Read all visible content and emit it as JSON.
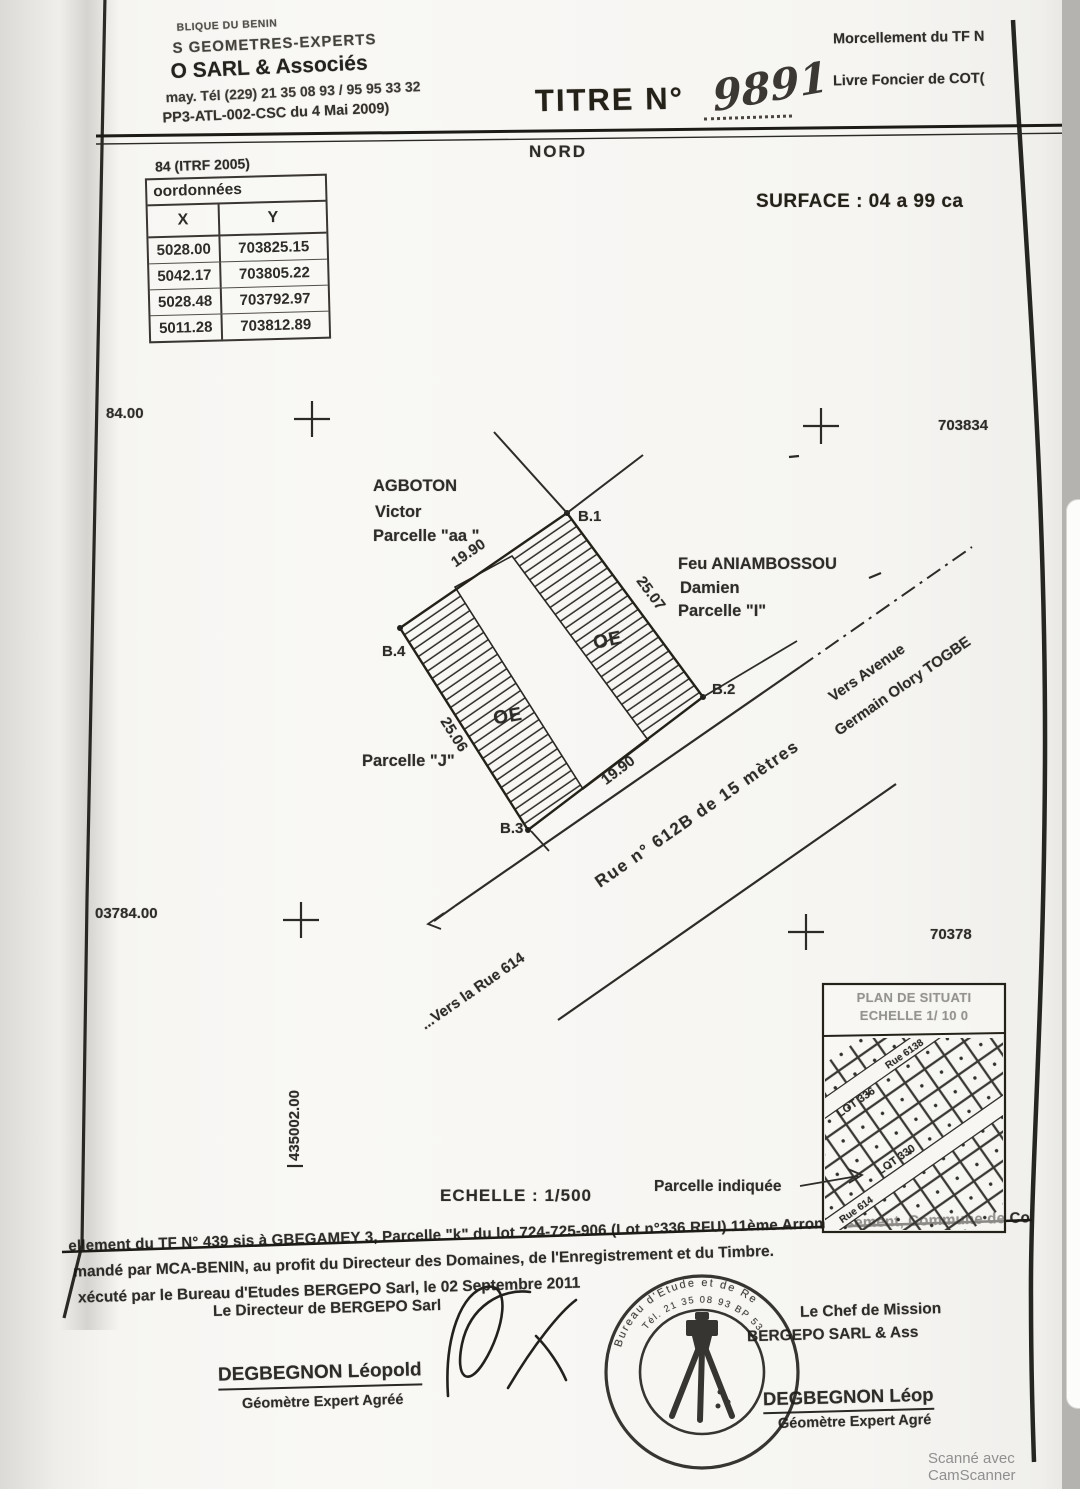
{
  "document": {
    "letterhead": {
      "line1": "BLIQUE DU BENIN",
      "line2": "S GEOMETRES-EXPERTS",
      "line3": "O SARL & Associés",
      "line4": "may. Tél  (229) 21 35 08 93 / 95 95 33 32",
      "line5": "PP3-ATL-002-CSC du 4 Mai 2009)"
    },
    "title_label": "TITRE N°",
    "title_number": "9891",
    "ref_right1": "Morcellement du TF N",
    "ref_right2": "Livre Foncier de COT(",
    "north_label": "NORD",
    "datum": "84 (ITRF 2005)",
    "surface": "SURFACE : 04 a 99 ca",
    "coords_table": {
      "title": "oordonnées",
      "col_x": "X",
      "col_y": "Y",
      "rows": [
        [
          "5028.00",
          "703825.15"
        ],
        [
          "5042.17",
          "703805.22"
        ],
        [
          "5028.48",
          "703792.97"
        ],
        [
          "5011.28",
          "703812.89"
        ]
      ]
    },
    "grid": {
      "left_top": "84.00",
      "right_top": "703834",
      "left_bottom": "03784.00",
      "right_bottom": "70378",
      "vertical": "435002.00"
    },
    "parcel": {
      "b1": "B.1",
      "b2": "B.2",
      "b3": "B.3",
      "b4": "B.4",
      "len_nw": "19.90",
      "len_ne": "25.07",
      "len_sw": "25.06",
      "len_se": "19.90",
      "oe": "OE",
      "neighbor_nw1": "AGBOTON",
      "neighbor_nw2": "Victor",
      "neighbor_nw3": "Parcelle \"aa \"",
      "neighbor_ne1": "Feu ANIAMBOSSOU",
      "neighbor_ne2": "Damien",
      "neighbor_ne3": "Parcelle \"I\"",
      "neighbor_sw": "Parcelle \"J\""
    },
    "roads": {
      "rue_612b": "Rue n° 612B de 15 mètres",
      "vers_rue_614": "...Vers la Rue 614",
      "vers_avenue1": "Vers Avenue",
      "vers_avenue2": "Germain Olory TOGBE"
    },
    "scale": "ECHELLE : 1/500",
    "situation": {
      "title1": "PLAN DE SITUATI",
      "title2": "ECHELLE 1/ 10 0",
      "lot_a": "LOT 336",
      "rue_a": "Rue 6138",
      "lot_b": "LOT 330",
      "rue_b": "Rue 614",
      "pointer": "Parcelle indiquée"
    },
    "footer": {
      "p1": "ellement du TF N° 439 sis à GBEGAMEY 3, Parcelle \"k\" du lot 724-725-906 (Lot n°336 RFU) 11ème Arrondissement, Commune de Co",
      "p2": "mandé par MCA-BENIN, au profit du Directeur des Domaines, de l'Enregistrement et du Timbre.",
      "p3": "xécuté par le Bureau d'Etudes BERGEPO Sarl, le 02 Septembre 2011",
      "left_role": "Le Directeur de BERGEPO Sarl",
      "left_name": "DEGBEGNON Léopold",
      "left_title": "Géomètre Expert Agréé",
      "right_role": "Le Chef de Mission",
      "right_org": "BERGEPO SARL & Ass",
      "right_name": "DEGBEGNON Léop",
      "right_title": "Géomètre Expert Agré"
    },
    "stamp": {
      "arc_top": "Bureau d'Etude et de Re",
      "arc_inner": "Tél. 21 35 08 93 BP 53 Coto"
    }
  },
  "viewer": {
    "watermark": "Scanné avec CamScanner"
  }
}
